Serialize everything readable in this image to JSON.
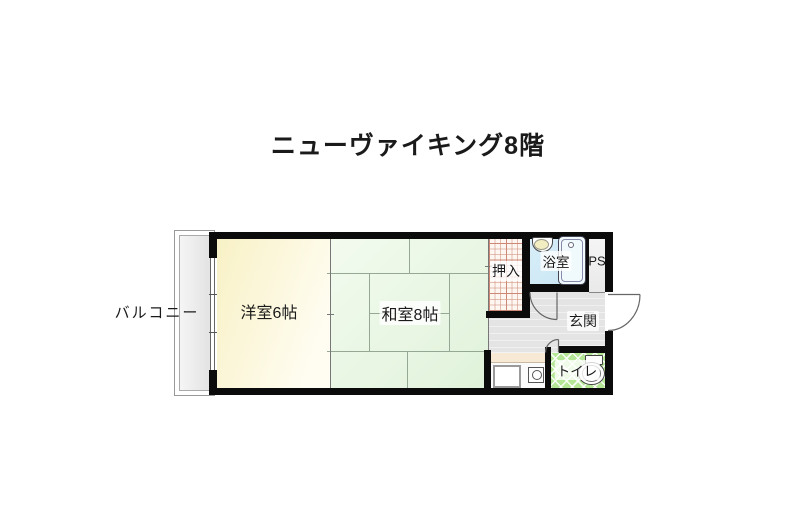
{
  "title": "ニューヴァイキング8階",
  "floor_plan": {
    "balcony": {
      "label": "バルコニー"
    },
    "western_room": {
      "label": "洋室6帖"
    },
    "japanese_room": {
      "label": "和室8帖"
    },
    "closet": {
      "label": "押入"
    },
    "bathroom": {
      "label": "浴室"
    },
    "pipe_space": {
      "label": "PS"
    },
    "entrance": {
      "label": "玄関"
    },
    "toilet": {
      "label": "トイレ"
    },
    "colors": {
      "wall": "#0b0b0b",
      "western_room": "#f8f1c6",
      "japanese_room": "#e4f4de",
      "bathroom": "#cfe9f5",
      "toilet_floor": "#b5e695",
      "closet_grid": "#cf8d79",
      "hall_floor": "#e4e4e4",
      "kitchen_counter": "#f7e9d3",
      "balcony": "#ececec"
    }
  }
}
